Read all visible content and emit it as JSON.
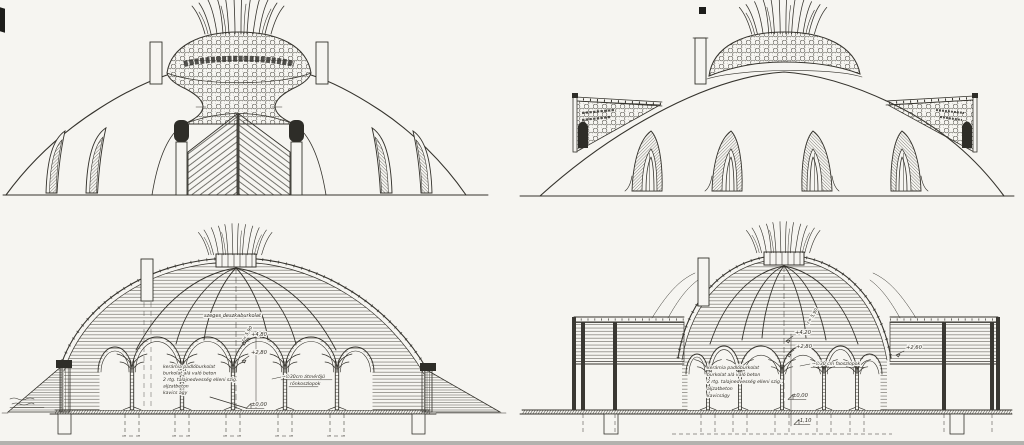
{
  "palette": {
    "paper": "#f6f5f1",
    "ink": "#35332d"
  },
  "section_cross": {
    "cladding_note": "szeges deszkaburkolat",
    "radius": "r= 5,90",
    "lvl_a": "+4,80",
    "lvl_b": "+2,80",
    "lvl_floor": "±0,00",
    "layers": [
      "kerámia padlóburkolat",
      "burkolat alá való beton",
      "2 rtg. talajnedvesség elleni szig.",
      "aljzatbeton",
      "kavics ágy"
    ],
    "col_note_1": "~∅30cm átmérőjű",
    "col_note_2": "rönkoszlopok"
  },
  "section_long": {
    "radius": "r= 5,90",
    "lvl_a": "+4,20",
    "lvl_b": "+2,80",
    "lvl_wing": "+2,60",
    "lvl_floor": "±0,00",
    "lvl_found": "-1,10",
    "layers": [
      "kerámia padlóburkolat",
      "burkolat alá való beton",
      "2 rtg. talajnedvesség elleni szig.",
      "aljzatbeton",
      "kavicságy"
    ],
    "col_note": "~∅30 cm faoszlopok"
  }
}
